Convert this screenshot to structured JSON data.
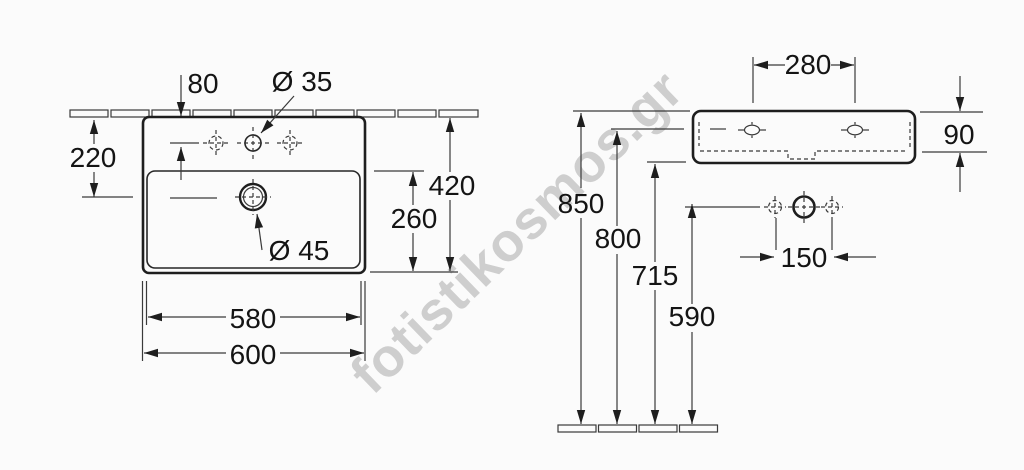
{
  "watermark": {
    "text": "fotistikosmos.gr",
    "color": "#c9c9c9"
  },
  "colors": {
    "line": "#1e1e1e",
    "dimension_line": "#3a3a3a",
    "background": "#fbfbfb"
  },
  "front_view": {
    "description": "washbasin plan view with wall line",
    "dims": {
      "tap_hole_offset": "80",
      "tap_hole_diameter": "Ø 35",
      "drain_offset_from_wall": "220",
      "overall_depth": "420",
      "bowl_depth": "260",
      "drain_diameter": "Ø 45",
      "bowl_width": "580",
      "overall_width": "600"
    }
  },
  "side_view": {
    "description": "washbasin side elevation with floor line",
    "dims": {
      "fixing_hole_spacing": "280",
      "basin_height": "90",
      "rim_height_from_floor": "850",
      "fixing_hole_height": "800",
      "underside_height": "715",
      "connection_height": "590",
      "connection_spacing": "150"
    }
  }
}
